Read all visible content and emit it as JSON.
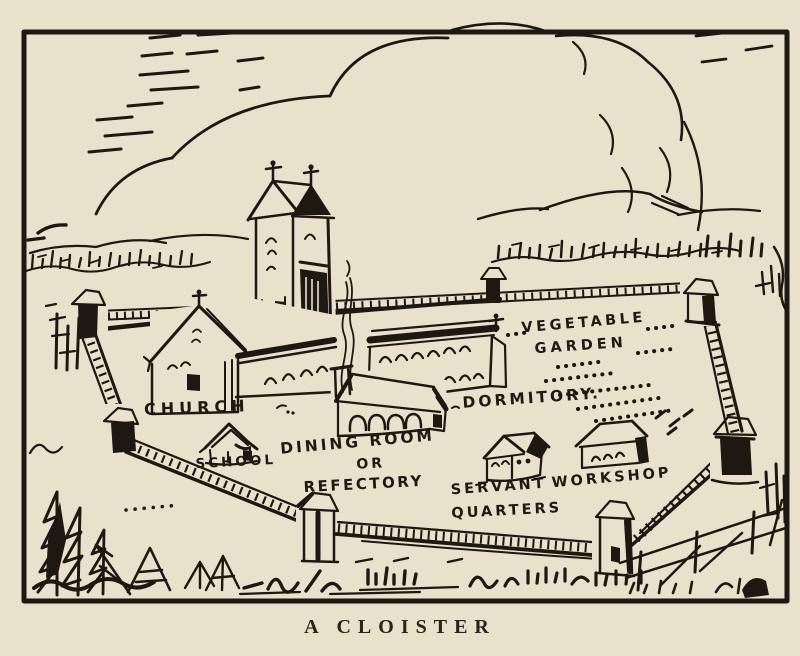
{
  "illustration": {
    "caption": "A CLOISTER",
    "labels": {
      "church": "CHURCH",
      "school": "SCHOOL",
      "dining_line1": "DINING ROOM",
      "dining_line2": "OR",
      "dining_line3": "REFECTORY",
      "dormitory": "DORMITORY.",
      "garden_line1": "VEGETABLE",
      "garden_line2": "GARDEN",
      "servant_line1": "SERVANT",
      "servant_line2": "QUARTERS",
      "workshop": "WORKSHOP"
    },
    "colors": {
      "ink": "#1f1812",
      "paper": "#e9e1cc"
    }
  }
}
